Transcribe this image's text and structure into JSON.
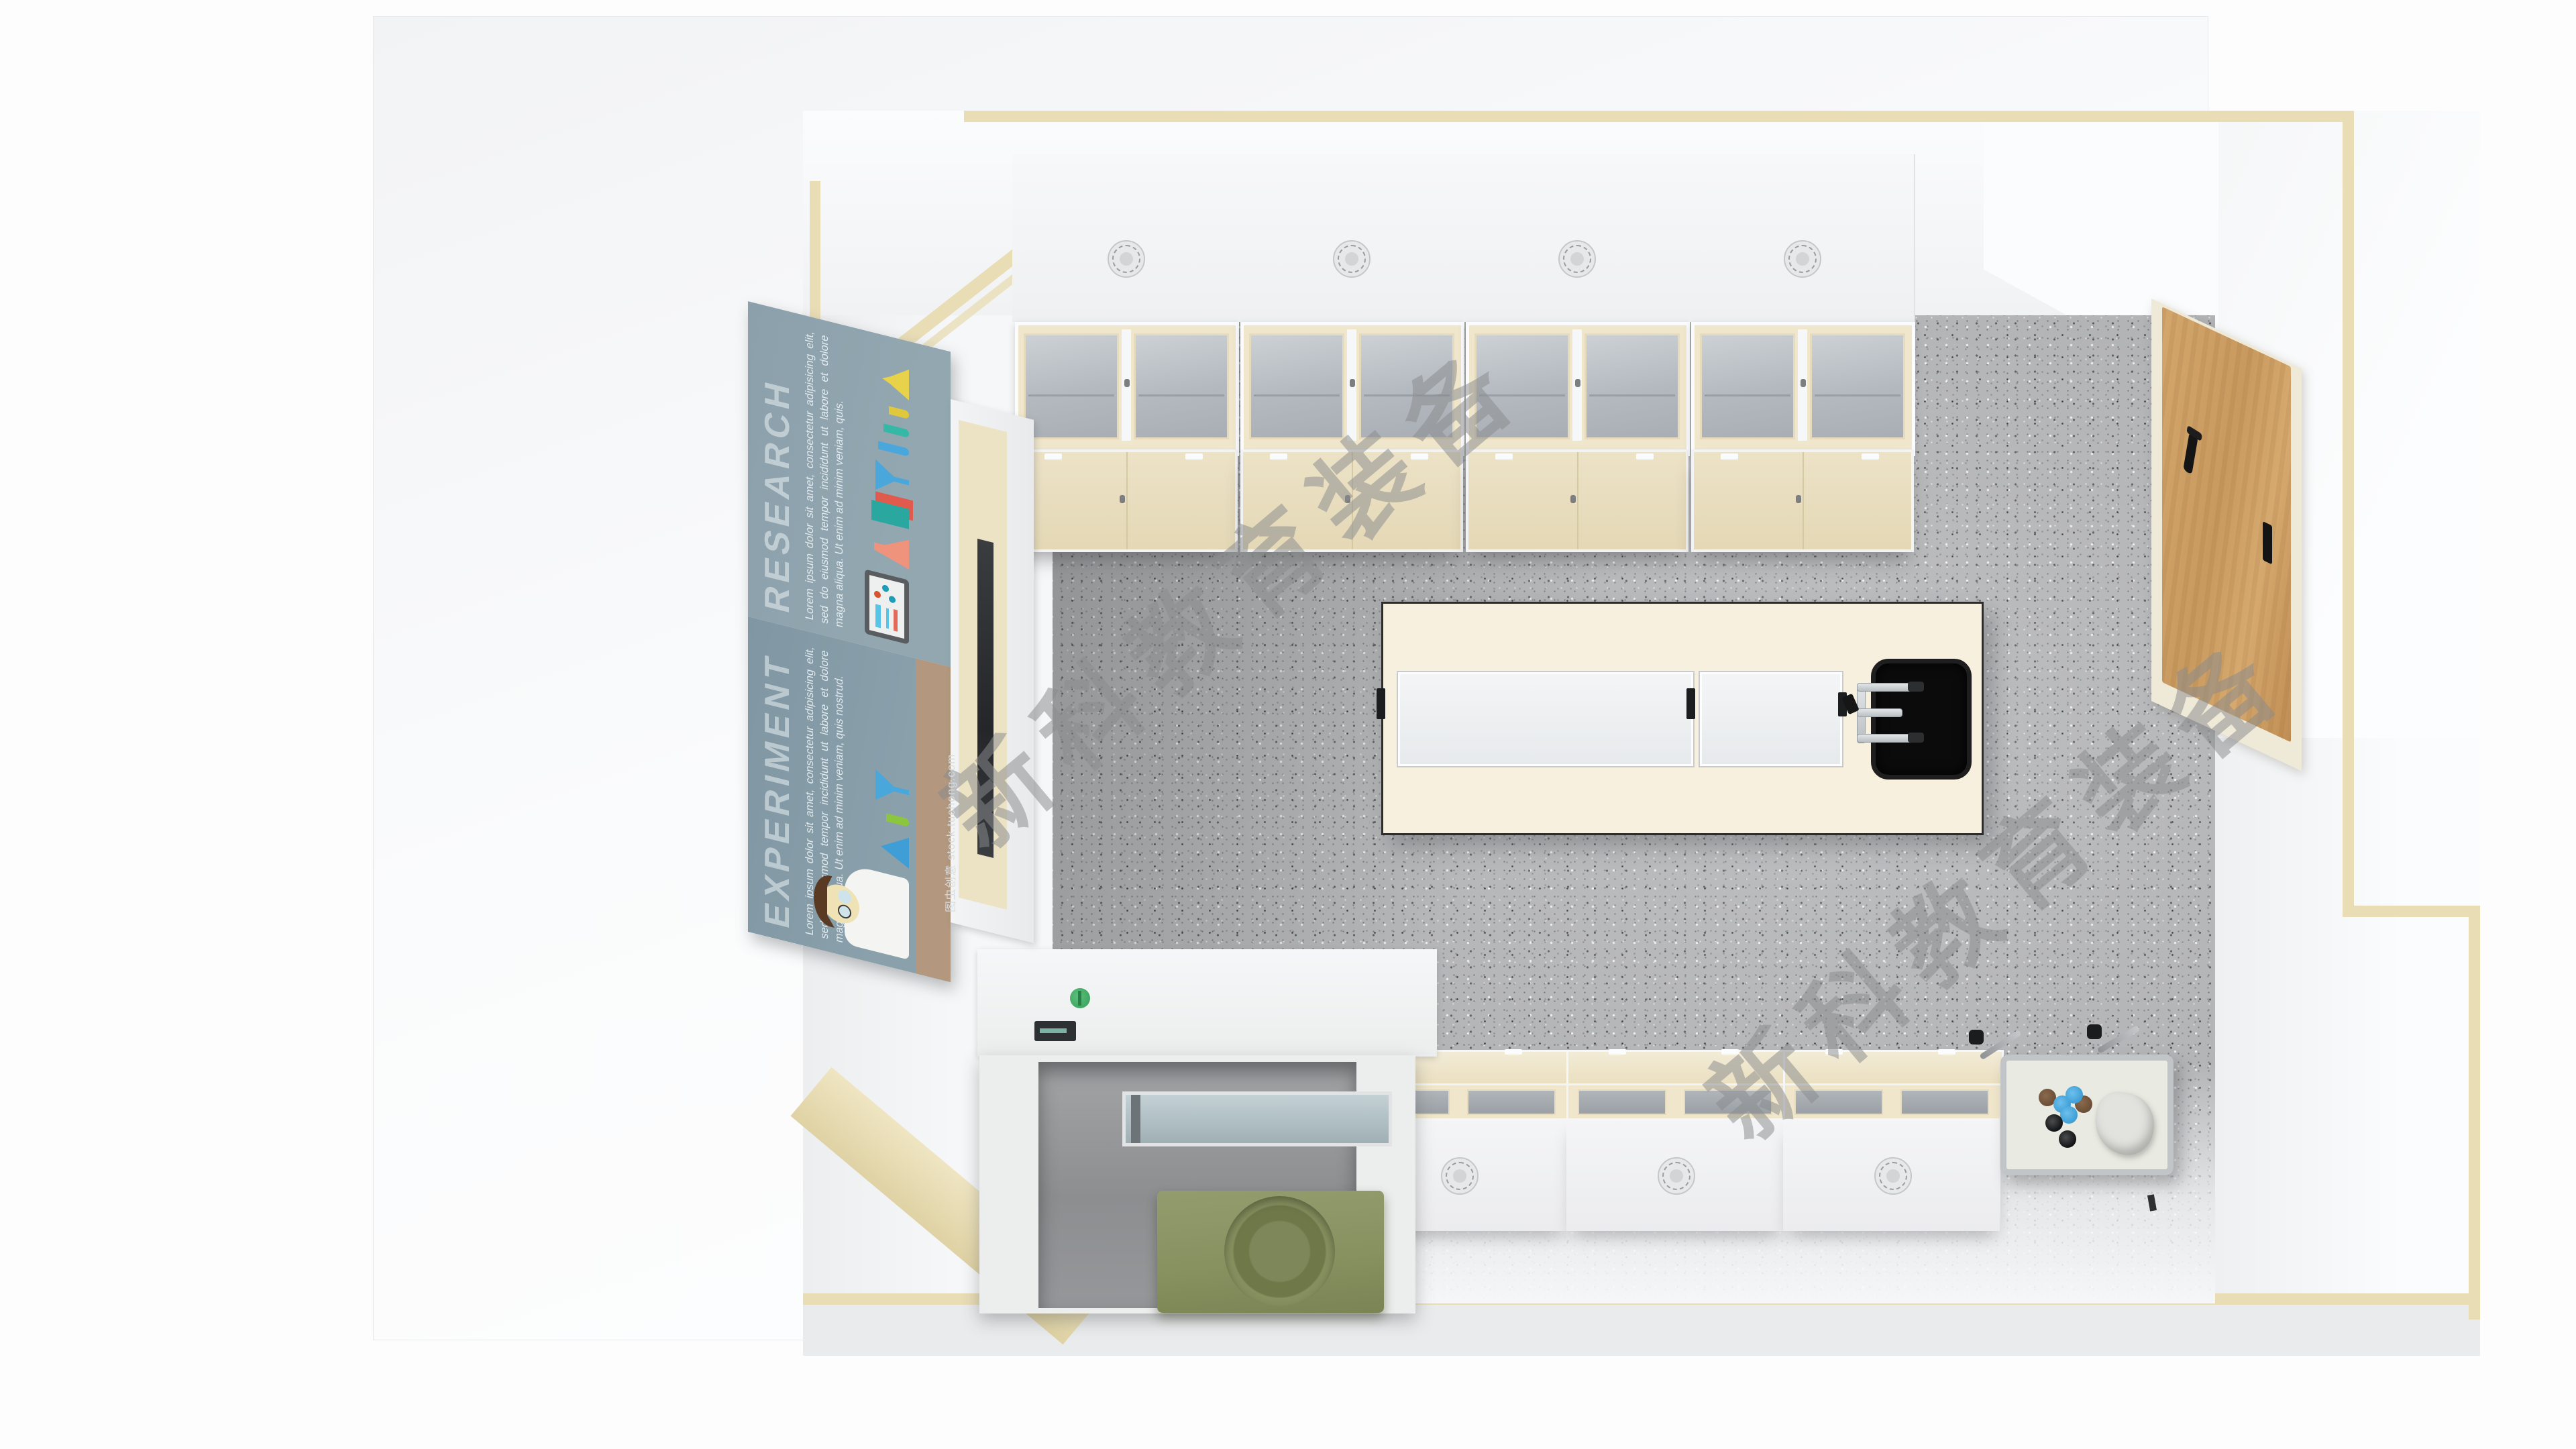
{
  "watermarks": {
    "brand": "新科教育装备",
    "stock": "图虫创意 stock.tuchong.com"
  },
  "poster": {
    "sections": [
      {
        "title": "RESEARCH",
        "body": "Lorem ipsum dolor sit amet, consectetur adipisicing elit, sed do eiusmod tempor incididunt ut labore et dolore magna aliqua. Ut enim ad minim veniam, quis."
      },
      {
        "title": "EXPERIMENT",
        "body": "Lorem ipsum dolor sit amet, consectetur adipisicing elit, sed do eiusmod tempor incididunt ut labore et dolore magna aliqua. Ut enim ad minim veniam, quis nostrud."
      }
    ]
  },
  "palette": {
    "page_bg": "#fdfdfe",
    "beige": "#e9ddb6",
    "floor": "#b2b3b5",
    "cream": "#efe6cb",
    "island": "#f7f0de",
    "sink": "#0b0b0b",
    "wood": "#d3a66c",
    "hood_green": "#87915f",
    "green_knob": "#3fa863",
    "blue": "#3f9ed6",
    "poster_top": "#8ba0ab",
    "poster_bottom": "#8097a3",
    "poster_tan": "#b3987f",
    "wm": "#8a8c8e"
  }
}
